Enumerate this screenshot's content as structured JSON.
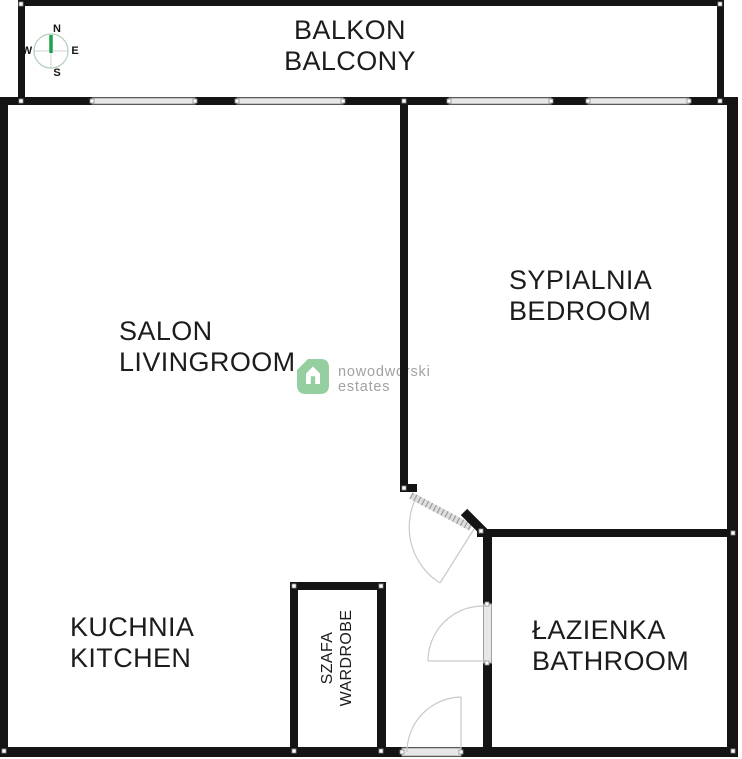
{
  "plan": {
    "type": "apartment-floorplan",
    "language": "pl/en"
  },
  "rooms": {
    "balcony": {
      "pl": "BALKON",
      "en": "BALCONY"
    },
    "livingroom": {
      "pl": "SALON",
      "en": "LIVINGROOM"
    },
    "bedroom": {
      "pl": "SYPIALNIA",
      "en": "BEDROOM"
    },
    "kitchen": {
      "pl": "KUCHNIA",
      "en": "KITCHEN"
    },
    "wardrobe": {
      "pl": "SZAFA",
      "en": "WARDROBE"
    },
    "bathroom": {
      "pl": "ŁAZIENKA",
      "en": "BATHROOM"
    }
  },
  "compass": {
    "north": "N",
    "east": "E",
    "south": "S",
    "west": "W",
    "needle_color": "#1fa04c"
  },
  "watermark": {
    "brand": "nowodworski",
    "suffix": "estates",
    "logo_color": "#8ccb97",
    "text_color": "#a2a2a2"
  },
  "colors": {
    "wall": "#141414",
    "window_fill": "#e7e7e7",
    "window_edge": "#9e9e9e",
    "door_arc": "#c9c9c9",
    "background": "#ffffff"
  }
}
